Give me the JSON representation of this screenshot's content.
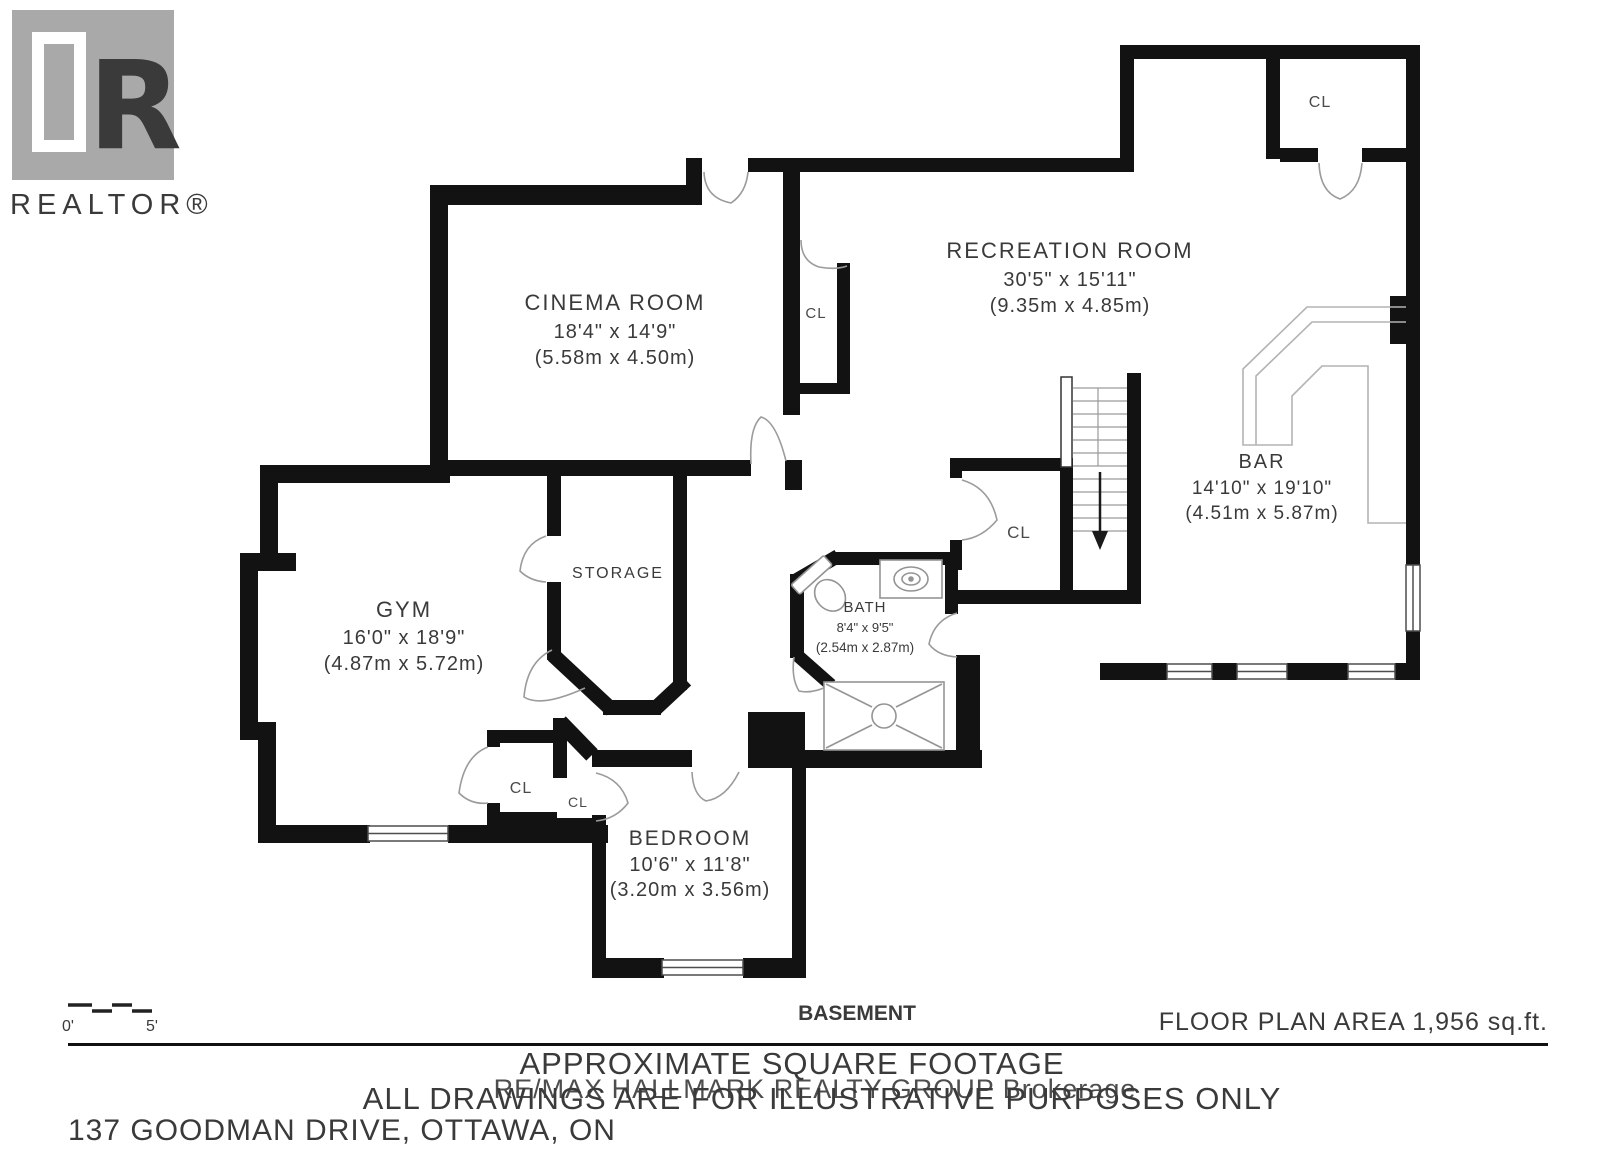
{
  "logo": {
    "letter": "R",
    "label": "REALTOR®"
  },
  "rooms": {
    "cinema": {
      "name": "CINEMA ROOM",
      "imperial": "18'4\" x 14'9\"",
      "metric": "(5.58m x 4.50m)"
    },
    "recreation": {
      "name": "RECREATION ROOM",
      "imperial": "30'5\" x 15'11\"",
      "metric": "(9.35m x 4.85m)"
    },
    "bar": {
      "name": "BAR",
      "imperial": "14'10\" x 19'10\"",
      "metric": "(4.51m x 5.87m)"
    },
    "gym": {
      "name": "GYM",
      "imperial": "16'0\" x 18'9\"",
      "metric": "(4.87m x 5.72m)"
    },
    "storage": {
      "name": "STORAGE"
    },
    "bath": {
      "name": "BATH",
      "imperial": "8'4\" x 9'5\"",
      "metric": "(2.54m x 2.87m)"
    },
    "bedroom": {
      "name": "BEDROOM",
      "imperial": "10'6\" x 11'8\"",
      "metric": "(3.20m x 3.56m)"
    }
  },
  "closet_label": "CL",
  "scale": {
    "start": "0'",
    "end": "5'"
  },
  "footer": {
    "level": "BASEMENT",
    "area": "FLOOR PLAN AREA 1,956 sq.ft.",
    "note1": "APPROXIMATE SQUARE FOOTAGE",
    "note2": "ALL DRAWINGS ARE FOR ILLUSTRATIVE PURPOSES ONLY",
    "address": "137 GOODMAN DRIVE, OTTAWA, ON"
  },
  "watermark": "RE/MAX HALLMARK REALTY GROUP Brokerage",
  "colors": {
    "wall": "#121212",
    "door_line": "#9b9b9b",
    "fixture_line": "#949494",
    "text": "#3a3a3a",
    "muted_text": "#7b7b7b",
    "logo_gray": "#a9a9a9",
    "watermark_gray": "#cdcdcd"
  }
}
